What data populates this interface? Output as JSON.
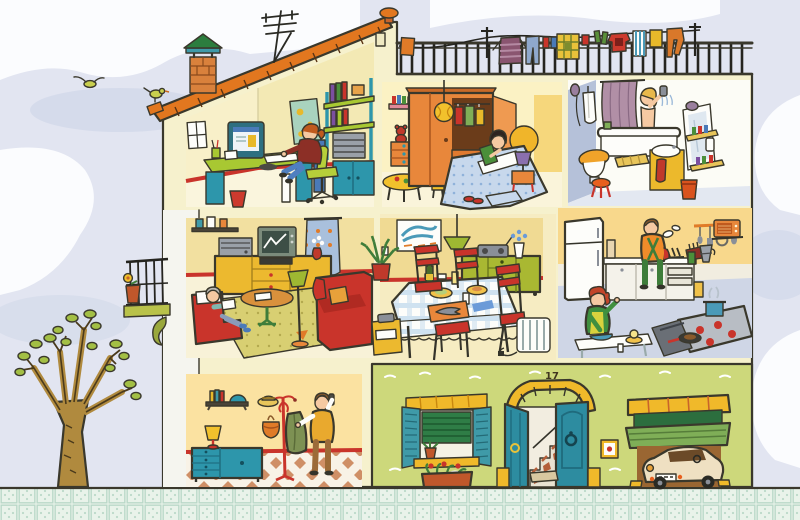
{
  "scene": {
    "type": "cutaway-house-illustration",
    "house_number": "17",
    "palette": {
      "sky": "#e2e5f1",
      "cloud": "#fbfcfe",
      "house_wall": "#f6f1cd",
      "roof_tile": "#e2771f",
      "ground_floor_wall": "#cdd87b",
      "sidewalk": "#e9f3ea",
      "accent_red": "#c9342b",
      "teal": "#2d96ab",
      "leaf_green": "#9eb832",
      "yellow": "#f0b52a",
      "orange": "#e8863b",
      "blue_gray": "#b5c1d9"
    },
    "exterior": {
      "roof": [
        "tiled-sloped-roof",
        "brick-chimney",
        "tv-antenna",
        "roof-finial",
        "gable-vent"
      ],
      "sky": [
        "clouds",
        "flying-bird",
        "perched-bird"
      ],
      "terrace": {
        "features": [
          "iron-railing",
          "clothesline"
        ],
        "clothesline_items": [
          "orange-towel",
          "striped-sweater",
          "jeans",
          "red-sock",
          "blue-sock",
          "checked-blanket",
          "red-cloth",
          "green-socks",
          "red-tshirt",
          "striped-towel",
          "yellow-shirt",
          "orange-trousers"
        ]
      },
      "left_side": [
        "iron-balcony",
        "balcony-flower-pot",
        "tree"
      ],
      "street_level": [
        "shuttered-window",
        "roller-blind",
        "window-box",
        "arched-door-with-staircase",
        "ceramic-plaque",
        "garage-roller-door",
        "vintage-car",
        "tiled-pavement"
      ]
    },
    "rooms": [
      {
        "name": "study",
        "position": "top-left",
        "people": [
          "woman-at-computer"
        ],
        "objects": [
          "window",
          "pinboard",
          "desk",
          "computer-monitor",
          "keyboard",
          "office-chair",
          "waste-bin",
          "shelving-unit",
          "books",
          "cd-tower",
          "cabinet"
        ]
      },
      {
        "name": "bedroom",
        "position": "top-middle",
        "people": [
          "girl-reading-in-bed"
        ],
        "objects": [
          "wardrobe",
          "hanging-ball-lamp",
          "wall-shelf",
          "teddy-bear",
          "chest-of-drawers",
          "toy-table",
          "stools",
          "bed",
          "headboard",
          "nightstand",
          "purple-lamp",
          "rug",
          "slippers"
        ]
      },
      {
        "name": "bathroom",
        "position": "top-right",
        "people": [
          "woman-showering"
        ],
        "objects": [
          "bathtub",
          "shower-curtain",
          "shower-head",
          "bathrobe",
          "toilet",
          "stool",
          "bath-mat",
          "washbasin-cabinet",
          "towel",
          "mirror",
          "toiletry-shelves",
          "pedal-bin"
        ]
      },
      {
        "name": "living-room",
        "position": "middle-left",
        "people": [
          "grandmother-reading"
        ],
        "objects": [
          "photo-shelf",
          "sideboard",
          "stereo",
          "television",
          "vcr",
          "flower-vase",
          "curtain",
          "armchair",
          "coffee-table",
          "floor-lamp",
          "sofa",
          "rug"
        ]
      },
      {
        "name": "dining-room",
        "position": "middle-center",
        "people": [],
        "objects": [
          "wave-picture",
          "pendant-lamp",
          "plant",
          "sideboard",
          "radio",
          "flower-vase",
          "dining-table",
          "red-chairs",
          "radiator",
          "telephone-table"
        ]
      },
      {
        "name": "kitchen",
        "position": "middle-right",
        "people": [
          "man-washing-dishes",
          "woman-mixing-bowl"
        ],
        "objects": [
          "fridge",
          "counter",
          "sink",
          "dish-rack",
          "utensil-rail",
          "microwave",
          "coffee-pot",
          "stove",
          "steaming-pot",
          "frying-pan",
          "oven-door",
          "kitchen-table",
          "mixing-bowl",
          "juicer",
          "salt-shaker"
        ]
      },
      {
        "name": "hallway",
        "position": "bottom-left",
        "people": [
          "man-on-phone"
        ],
        "objects": [
          "wall-shelf",
          "books",
          "helmet",
          "sideboard",
          "table-lamp",
          "coat-stand",
          "straw-hat",
          "bag",
          "green-coat",
          "checkered-floor"
        ]
      }
    ]
  }
}
